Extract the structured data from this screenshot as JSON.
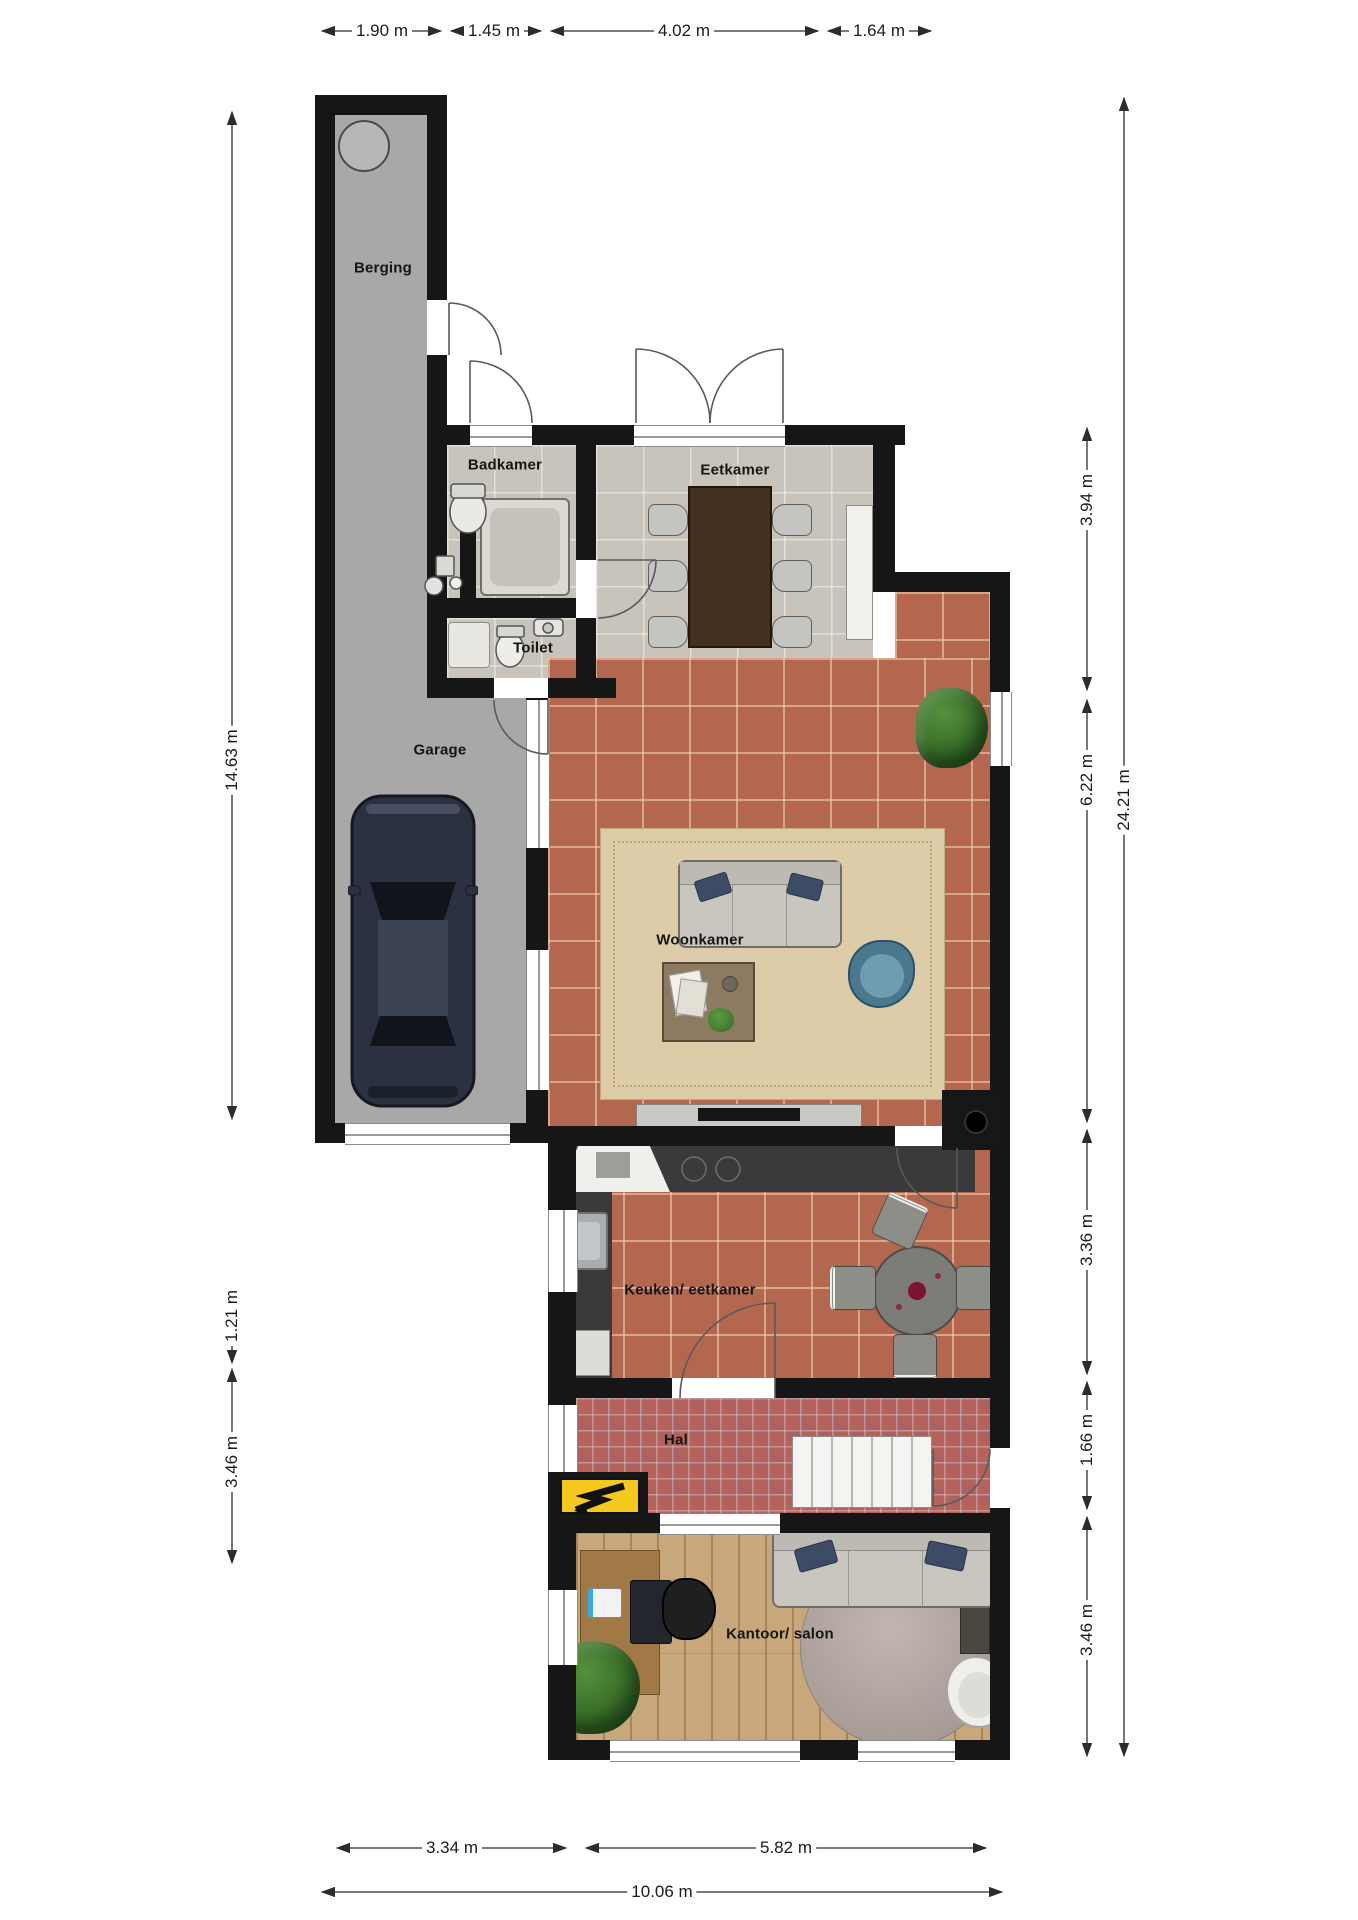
{
  "rooms": [
    {
      "id": "berging",
      "label": "Berging"
    },
    {
      "id": "badkamer",
      "label": "Badkamer"
    },
    {
      "id": "eetkamer",
      "label": "Eetkamer"
    },
    {
      "id": "toilet",
      "label": "Toilet"
    },
    {
      "id": "garage",
      "label": "Garage"
    },
    {
      "id": "woonkamer",
      "label": "Woonkamer"
    },
    {
      "id": "keuken",
      "label": "Keuken/ eetkamer"
    },
    {
      "id": "hal",
      "label": "Hal"
    },
    {
      "id": "kantoor",
      "label": "Kantoor/ salon"
    }
  ],
  "dimensions": {
    "top": [
      "1.90 m",
      "1.45 m",
      "4.02 m",
      "1.64 m"
    ],
    "left": [
      "14.63 m",
      "1.21 m",
      "3.46 m"
    ],
    "right": [
      "3.94 m",
      "6.22 m",
      "3.36 m",
      "1.66 m",
      "3.46 m"
    ],
    "right_total": "24.21 m",
    "bottom": [
      "3.34 m",
      "5.82 m"
    ],
    "bottom_total": "10.06 m"
  },
  "colors": {
    "wall": "#161616",
    "terracotta_floor": "#b4674f",
    "gray_tile_floor": "#c9c4bb",
    "concrete_floor": "#a8a8a8",
    "hall_tile_floor": "#b4625a",
    "wood_floor": "#c9a77c",
    "electric_panel": "#f4c81c"
  }
}
